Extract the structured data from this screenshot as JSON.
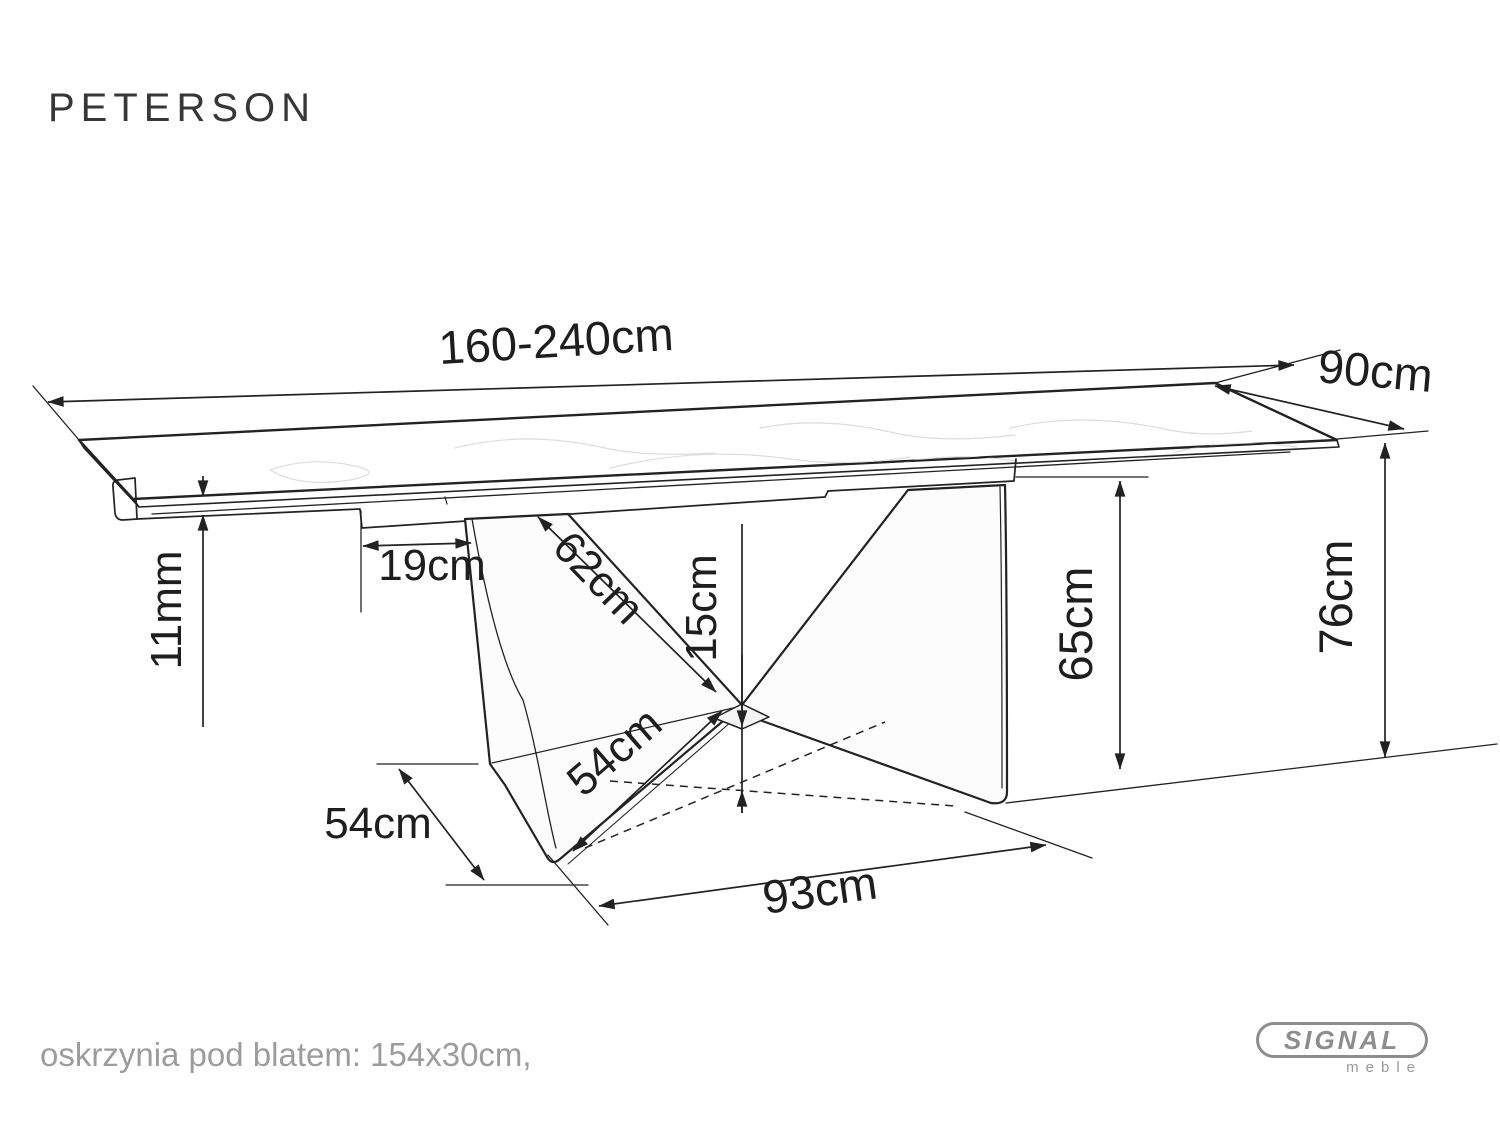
{
  "page": {
    "title": "PETERSON"
  },
  "dimensions": {
    "length": "160-240cm",
    "width": "90cm",
    "top_thickness": "11mm",
    "apron_inset": "19cm",
    "panel_edge": "62cm",
    "clearance": "15cm",
    "foot_diagonal": "54cm",
    "base_depth": "54cm",
    "apron_height": "65cm",
    "table_height": "76cm",
    "base_length": "93cm"
  },
  "footer": {
    "note": "oskrzynia pod blatem: 154x30cm,"
  },
  "logo": {
    "brand": "SIGNAL",
    "sub": "meble"
  },
  "colors": {
    "line": "#222222",
    "muted": "#9c9c9c",
    "logo_gray": "#8d8d8d"
  }
}
